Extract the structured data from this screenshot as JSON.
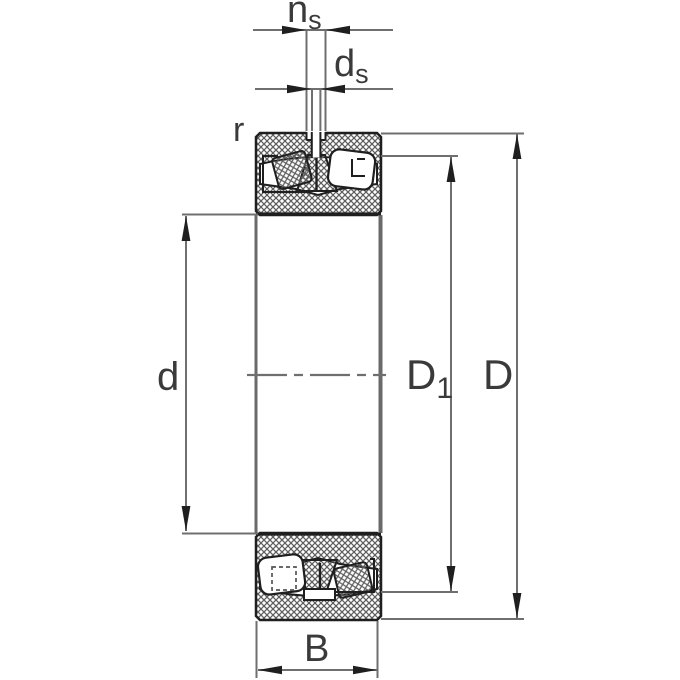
{
  "drawing": {
    "kind": "spherical-roller-bearing-cross-section",
    "labels": {
      "ns_base": "n",
      "ns_sub": "s",
      "ds_base": "d",
      "ds_sub": "s",
      "r": "r",
      "d": "d",
      "d1_base": "D",
      "d1_sub": "1",
      "D": "D",
      "B": "B"
    },
    "colors": {
      "background": "#ffffff",
      "outline": "#1f1f1f",
      "hatch": "#5f5f5f",
      "dimension_lines": "#6f6f6f",
      "arrowheads": "#1f1f1f",
      "label_text": "#3a3a3a"
    }
  }
}
